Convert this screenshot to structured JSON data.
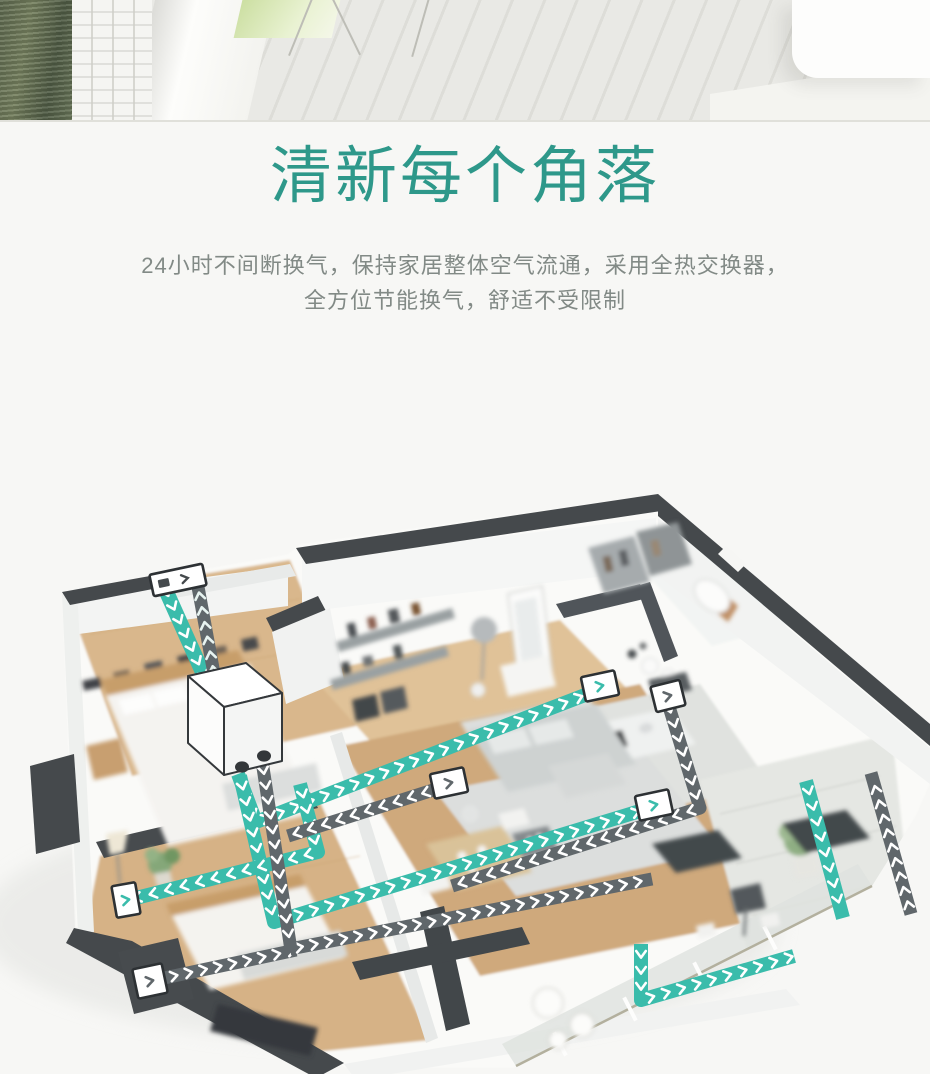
{
  "headline": {
    "line1": "一机管理全屋空气",
    "line2": "清新每个角落",
    "color": "#2e988a"
  },
  "subheadline": {
    "line1": "24小时不间断换气，保持家居整体空气流通，采用全热交换器，",
    "line2": "全方位节能换气，舒适不受限制"
  },
  "colors": {
    "page_background": "#f7f7f5",
    "headline_teal": "#2e988a",
    "subtitle_gray": "#828a86",
    "supply_duct_teal": "#3abcab",
    "return_duct_gray": "#60676b",
    "wall_dark": "#45494c",
    "wood_floor": "#d6b286"
  },
  "illustration": {
    "unit": {
      "name": "heat-recovery-ventilation-unit"
    },
    "ducts": [
      {
        "id": "fresh-air-intake",
        "color": "#3abcab",
        "chev": "#ffffff",
        "w": 15,
        "gap": 15,
        "points": [
          [
            163,
            100
          ],
          [
            206,
            196
          ]
        ]
      },
      {
        "id": "exhaust-outlet",
        "color": "#60676b",
        "chev": "#e8f4f1",
        "w": 13,
        "gap": 15,
        "points": [
          [
            215,
            195
          ],
          [
            196,
            92
          ]
        ]
      },
      {
        "id": "supply-hallway",
        "color": "#3abcab",
        "chev": "#ffffff",
        "w": 14,
        "gap": 16,
        "points": [
          [
            238,
            290
          ],
          [
            256,
            338
          ],
          [
            598,
            206
          ]
        ]
      },
      {
        "id": "supply-living",
        "color": "#3abcab",
        "chev": "#ffffff",
        "w": 14,
        "gap": 16,
        "points": [
          [
            240,
            292
          ],
          [
            274,
            438
          ],
          [
            650,
            324
          ]
        ]
      },
      {
        "id": "supply-bedroom-2",
        "color": "#3abcab",
        "chev": "#ffffff",
        "w": 14,
        "gap": 16,
        "points": [
          [
            300,
            300
          ],
          [
            318,
            368
          ],
          [
            128,
            416
          ]
        ]
      },
      {
        "id": "supply-balcony",
        "color": "#3abcab",
        "chev": "#ffffff",
        "w": 14,
        "gap": 16,
        "points": [
          [
            641,
            460
          ],
          [
            641,
            516
          ],
          [
            794,
            472
          ]
        ]
      },
      {
        "id": "return-living",
        "color": "#60676b",
        "chev": "#ffffff",
        "w": 13,
        "gap": 15,
        "points": [
          [
            449,
            301
          ],
          [
            288,
            352
          ]
        ]
      },
      {
        "id": "return-kitchen",
        "color": "#60676b",
        "chev": "#ffffff",
        "w": 13,
        "gap": 15,
        "points": [
          [
            667,
            216
          ],
          [
            700,
            324
          ],
          [
            452,
            402
          ]
        ]
      },
      {
        "id": "return-bedroom-2",
        "color": "#60676b",
        "chev": "#ffffff",
        "w": 13,
        "gap": 15,
        "points": [
          [
            150,
            497
          ],
          [
            296,
            466
          ]
        ]
      },
      {
        "id": "return-branch",
        "color": "#60676b",
        "chev": "#ffffff",
        "w": 13,
        "gap": 15,
        "points": [
          [
            290,
            465
          ],
          [
            652,
            395
          ]
        ]
      },
      {
        "id": "return-trunk",
        "color": "#60676b",
        "chev": "#ffffff",
        "w": 13,
        "gap": 15,
        "points": [
          [
            262,
            277
          ],
          [
            291,
            466
          ]
        ]
      },
      {
        "id": "supply-right",
        "color": "#3abcab",
        "chev": "#ffffff",
        "w": 14,
        "gap": 16,
        "points": [
          [
            806,
            297
          ],
          [
            843,
            434
          ]
        ]
      },
      {
        "id": "return-right",
        "color": "#60676b",
        "chev": "#ffffff",
        "w": 13,
        "gap": 15,
        "points": [
          [
            911,
            430
          ],
          [
            871,
            289
          ]
        ]
      }
    ],
    "vents": [
      {
        "id": "outdoor-terminal",
        "cx": 178,
        "cy": 96,
        "w": 54,
        "h": 22,
        "rot": -12,
        "accent": "#45494c",
        "type": "terminal"
      },
      {
        "id": "hallway",
        "cx": 600,
        "cy": 202,
        "w": 34,
        "h": 25,
        "rot": -12,
        "accent": "#3abcab",
        "type": "diffuser"
      },
      {
        "id": "living-room",
        "cx": 449,
        "cy": 299,
        "w": 34,
        "h": 25,
        "rot": -12,
        "accent": "#60676b",
        "type": "diffuser"
      },
      {
        "id": "bedroom-2-wall",
        "cx": 126,
        "cy": 416,
        "w": 24,
        "h": 32,
        "rot": -10,
        "accent": "#3abcab",
        "type": "diffuser"
      },
      {
        "id": "bedroom-2-bottom",
        "cx": 150,
        "cy": 497,
        "w": 30,
        "h": 30,
        "rot": -12,
        "accent": "#60676b",
        "type": "diffuser"
      },
      {
        "id": "dining",
        "cx": 654,
        "cy": 321,
        "w": 34,
        "h": 25,
        "rot": -12,
        "accent": "#3abcab",
        "type": "diffuser"
      },
      {
        "id": "kitchen",
        "cx": 668,
        "cy": 212,
        "w": 30,
        "h": 26,
        "rot": -14,
        "accent": "#60676b",
        "type": "diffuser"
      }
    ]
  }
}
